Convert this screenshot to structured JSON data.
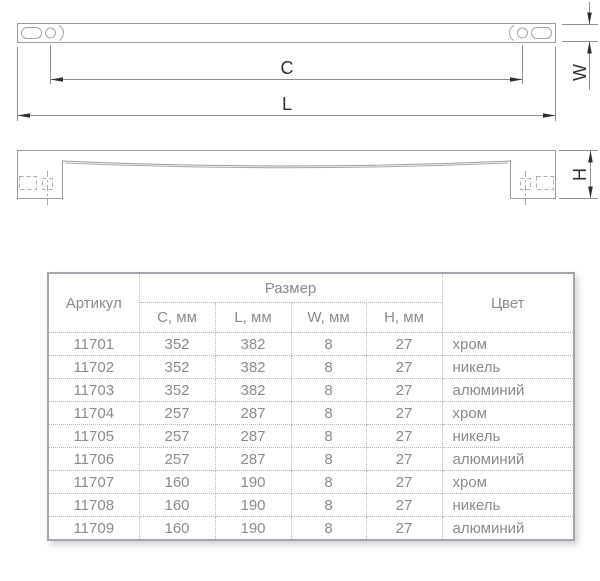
{
  "drawing": {
    "dim_c": "C",
    "dim_l": "L",
    "dim_w": "W",
    "dim_h": "H"
  },
  "table": {
    "header": {
      "article": "Артикул",
      "size_group": "Размер",
      "color": "Цвет",
      "size_cols": [
        "C, мм",
        "L, мм",
        "W, мм",
        "H, мм"
      ]
    },
    "rows": [
      [
        "11701",
        "352",
        "382",
        "8",
        "27",
        "хром"
      ],
      [
        "11702",
        "352",
        "382",
        "8",
        "27",
        "никель"
      ],
      [
        "11703",
        "352",
        "382",
        "8",
        "27",
        "алюминий"
      ],
      [
        "11704",
        "257",
        "287",
        "8",
        "27",
        "хром"
      ],
      [
        "11705",
        "257",
        "287",
        "8",
        "27",
        "никель"
      ],
      [
        "11706",
        "257",
        "287",
        "8",
        "27",
        "алюминий"
      ],
      [
        "11707",
        "160",
        "190",
        "8",
        "27",
        "хром"
      ],
      [
        "11708",
        "160",
        "190",
        "8",
        "27",
        "никель"
      ],
      [
        "11709",
        "160",
        "190",
        "8",
        "27",
        "алюминий"
      ]
    ]
  },
  "colors": {
    "table_border": "#a2a6ac",
    "table_grid": "#b9b9bc",
    "table_text": "#8b8b8b",
    "part_line": "#9b9b9b",
    "dim_line": "#8f8f8f",
    "dim_text": "#2f2f2f"
  }
}
